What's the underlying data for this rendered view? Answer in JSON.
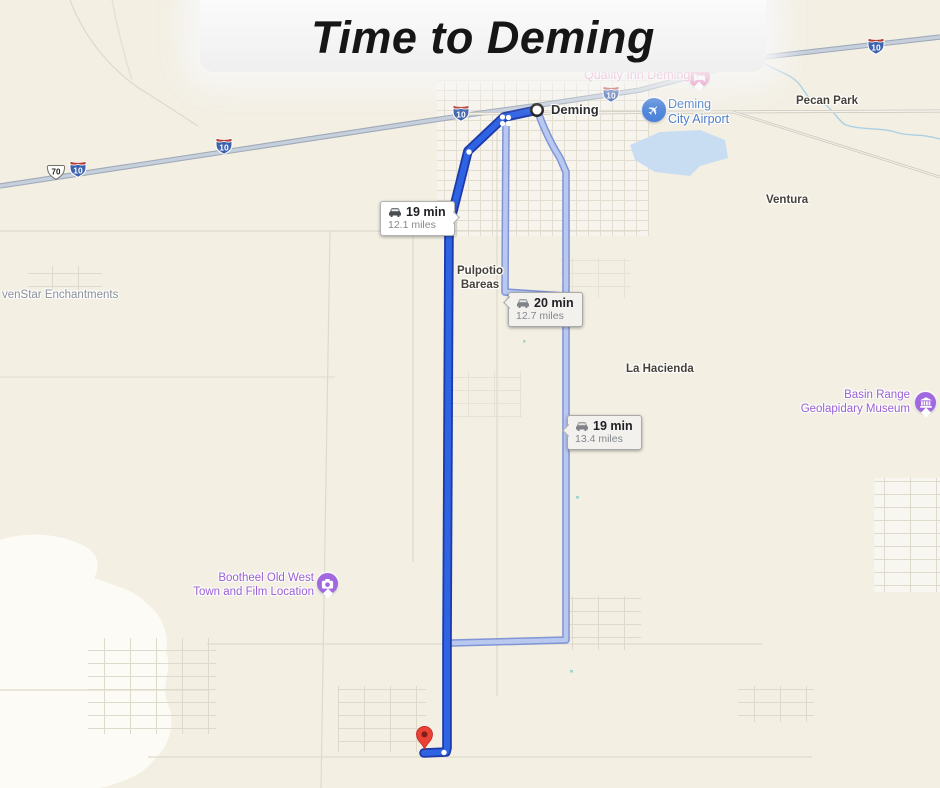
{
  "title": "Time to Deming",
  "routes": [
    {
      "duration": "19 min",
      "distance": "12.1 miles",
      "kind": "primary"
    },
    {
      "duration": "20 min",
      "distance": "12.7 miles",
      "kind": "alternate"
    },
    {
      "duration": "19 min",
      "distance": "13.4 miles",
      "kind": "alternate"
    }
  ],
  "places": {
    "quality_inn": "Quality Inn Deming",
    "deming": "Deming",
    "airport1": "Deming",
    "airport2": "City Airport",
    "pecan_park": "Pecan Park",
    "ventura": "Ventura",
    "pulpotio1": "Pulpotio",
    "pulpotio2": "Bareas",
    "la_hacienda": "La Hacienda",
    "basin1": "Basin Range",
    "basin2": "Geolapidary Museum",
    "sevenstar": "venStar Enchantments",
    "bootheel1": "Bootheel Old West",
    "bootheel2": "Town and Film Location"
  },
  "shields": {
    "i10": "10",
    "us70": "70"
  },
  "icons": {
    "hotel": "bed-icon",
    "airport": "airplane-icon",
    "attraction": "camera-icon",
    "museum": "museum-icon",
    "route_bubble": "car-icon",
    "destination": "map-pin-icon",
    "origin": "start-circle-icon"
  },
  "colors": {
    "primary_route": "#2e63e3",
    "primary_route_casing": "#1d3aa8",
    "alternate_route": "#b9c8ef",
    "alternate_route_casing": "#8094d6",
    "map_background": "#f3efe3",
    "poi_pink": "#d8489c",
    "poi_purple": "#9a5fd4",
    "poi_blue": "#4b7bc6",
    "pin_red": "#ea4335",
    "water": "#c9ddf2"
  }
}
